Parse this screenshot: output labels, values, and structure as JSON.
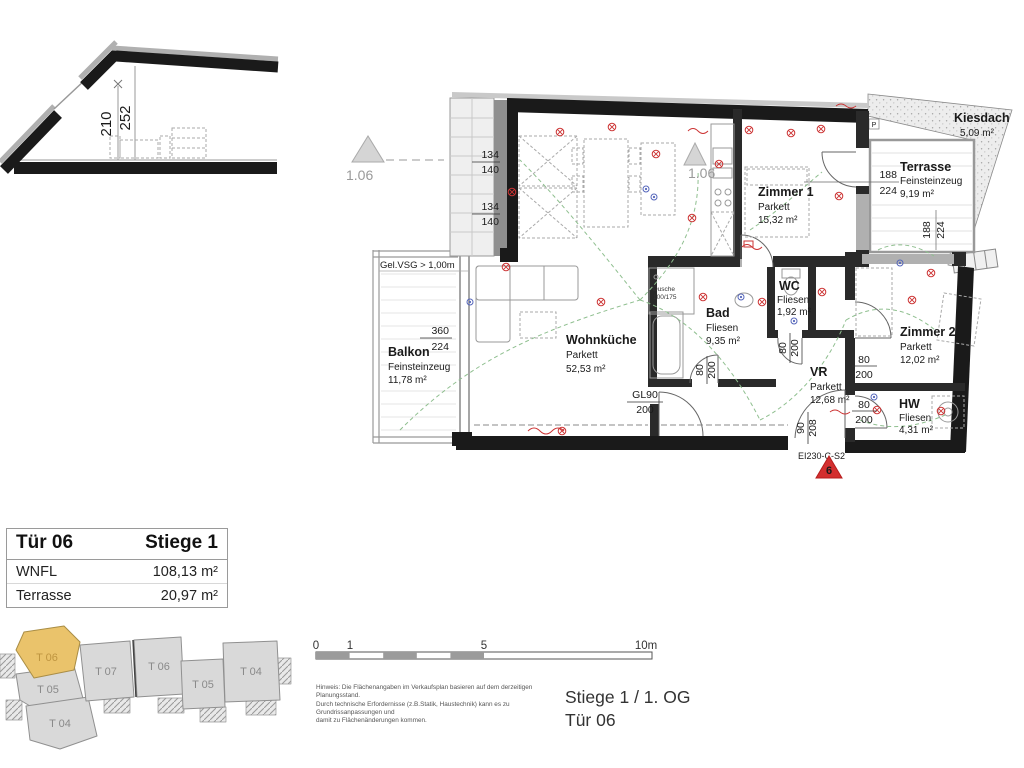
{
  "section": {
    "dim_inner": "210",
    "dim_total": "252"
  },
  "plan": {
    "markers": {
      "level_a": "1.06",
      "level_b": "1.06",
      "entrance_no": "6",
      "fire_rating": "EI230-C-S2",
      "p": "P"
    },
    "notes": {
      "glass_rail": "Gel.VSG > 1,00m"
    },
    "fixtures": {
      "shower": "Dusche",
      "shower_size": "100/175"
    },
    "icons": {
      "ceiling_light": "circled-cross",
      "socket": "double-circle",
      "washing_machine": "circle-in-square"
    },
    "rooms": {
      "balkon": {
        "name": "Balkon",
        "material": "Feinsteinzeug",
        "area": "11,78 m²"
      },
      "wohnkueche": {
        "name": "Wohnküche",
        "material": "Parkett",
        "area": "52,53 m²"
      },
      "zimmer1": {
        "name": "Zimmer 1",
        "material": "Parkett",
        "area": "15,32 m²"
      },
      "terrasse": {
        "name": "Terrasse",
        "material": "Feinsteinzeug",
        "area": "9,19 m²"
      },
      "kiesdach": {
        "name": "Kiesdach",
        "area": "5,09 m²"
      },
      "bad": {
        "name": "Bad",
        "material": "Fliesen",
        "area": "9,35 m²"
      },
      "wc": {
        "name": "WC",
        "material": "Fliesen",
        "area": "1,92 m²"
      },
      "zimmer2": {
        "name": "Zimmer 2",
        "material": "Parkett",
        "area": "12,02 m²"
      },
      "vr": {
        "name": "VR",
        "material": "Parkett",
        "area": "12,68 m²"
      },
      "hw": {
        "name": "HW",
        "material": "Fliesen",
        "area": "4,31 m²"
      }
    },
    "dims": {
      "win_a_1": "134",
      "win_a_2": "140",
      "win_b_1": "134",
      "win_b_2": "140",
      "balcony_w": "360",
      "balcony_h": "224",
      "terrace_w": "188",
      "terrace_h": "224",
      "terrace_win_w": "188",
      "terrace_win_h": "224",
      "bad_door_w": "80",
      "bad_door_h": "200",
      "wc_door_w": "80",
      "wc_door_h": "200",
      "z2_door_w": "80",
      "z2_door_h": "200",
      "hw_door_w": "80",
      "hw_door_h": "200",
      "entry_door_w": "90",
      "entry_door_h": "208",
      "glass_door_w": "GL90",
      "glass_door_h": "200"
    }
  },
  "info_table": {
    "door": "Tür 06",
    "staircase": "Stiege 1",
    "rows": [
      {
        "label": "WNFL",
        "value": "108,13 m²"
      },
      {
        "label": "Terrasse",
        "value": "20,97 m²"
      }
    ]
  },
  "overview": {
    "units": [
      "T 06",
      "T 05",
      "T 04",
      "T 07",
      "T 06",
      "T 05",
      "T 04"
    ],
    "highlighted_unit": "T 06"
  },
  "scale_bar": {
    "t0": "0",
    "t1": "1",
    "t5": "5",
    "t10": "10m"
  },
  "footer": {
    "disclaimer": [
      "Hinweis: Die Flächenangaben im Verkaufsplan basieren auf dem derzeitigen Planungsstand.",
      "Durch technische Erfordernisse (z.B.Statik, Haustechnik) kann es zu Grundrissanpassungen und",
      "damit zu Flächenänderungen kommen."
    ],
    "location": "Stiege 1 / 1. OG",
    "unit": "Tür 06"
  },
  "colors": {
    "wall": "#1a1a1a",
    "unit_highlight": "#eac36b",
    "marker_red": "#d32f2f",
    "cable_green": "#8fbf8f",
    "symbol_red": "#cc3333",
    "symbol_blue": "#5566bb"
  }
}
